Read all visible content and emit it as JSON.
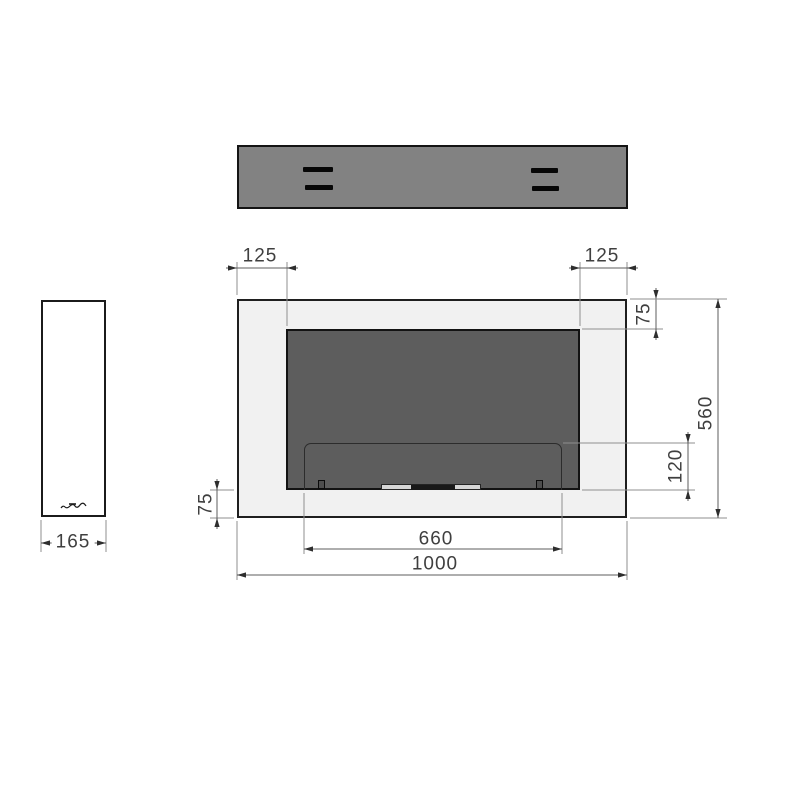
{
  "drawing": {
    "type": "technical-dimension-drawing",
    "subject": "wall-mounted-bioethanol-fireplace",
    "views": [
      "top-view",
      "side-view",
      "front-view"
    ],
    "units_shown": "mm"
  },
  "dimensions": {
    "left_offset": "125",
    "right_offset": "125",
    "top_inset": "75",
    "overall_height": "560",
    "opening_bottom_height": "120",
    "bottom_inset": "75",
    "opening_width": "660",
    "overall_width": "1000",
    "depth": "165"
  },
  "colors": {
    "background": "#ffffff",
    "top_view_fill": "#828282",
    "frame_fill": "#f1f1f1",
    "firebox_fill": "#5d5d5d",
    "outline": "#1b1b1b",
    "dimension_line": "#5c5c5c",
    "extension_line": "#8f8f8f",
    "text": "#3f3f3f"
  },
  "icons": {
    "side_view_logo": "brand-signature-scribble"
  }
}
